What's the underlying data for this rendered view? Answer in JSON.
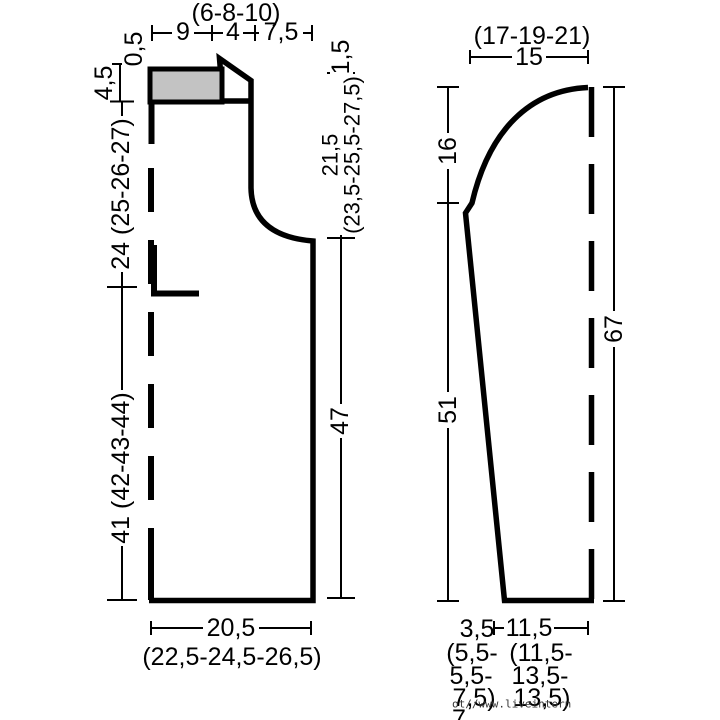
{
  "diagram": {
    "front": {
      "top_seg1": "9",
      "top_seg2": "4",
      "top_seg2_sizes": "(6-8-10)",
      "top_seg3": "7,5",
      "left_h1": "0,5",
      "left_h2": "4,5",
      "left_h3": "24 (25-26-27)",
      "left_h4": "41 (42-43-44)",
      "right_h1": "1,5",
      "right_h2a": "21,5",
      "right_h2b": "(23,5-25,5-27,5)",
      "right_h3": "47",
      "bottom_width": "20,5",
      "bottom_width_sizes": "(22,5-24,5-26,5)"
    },
    "sleeve": {
      "top_width": "15",
      "top_width_sizes": "(17-19-21)",
      "left_h1": "16",
      "left_h2": "51",
      "right_h1": "67",
      "bottom_w1": "3,5",
      "bottom_w2": "11,5",
      "bottom_w1_sizes": [
        "(5,5-",
        "5,5-",
        "7,5)"
      ],
      "bottom_w2_sizes": [
        "(11,5-",
        "13,5-",
        "13,5)"
      ],
      "bottom_cutoff": "7"
    },
    "watermark": "ot//www.liveintern",
    "colors": {
      "line": "#000000",
      "shoulder_fill": "#c3c3c3",
      "background": "#ffffff",
      "watermark": "#333333"
    }
  }
}
